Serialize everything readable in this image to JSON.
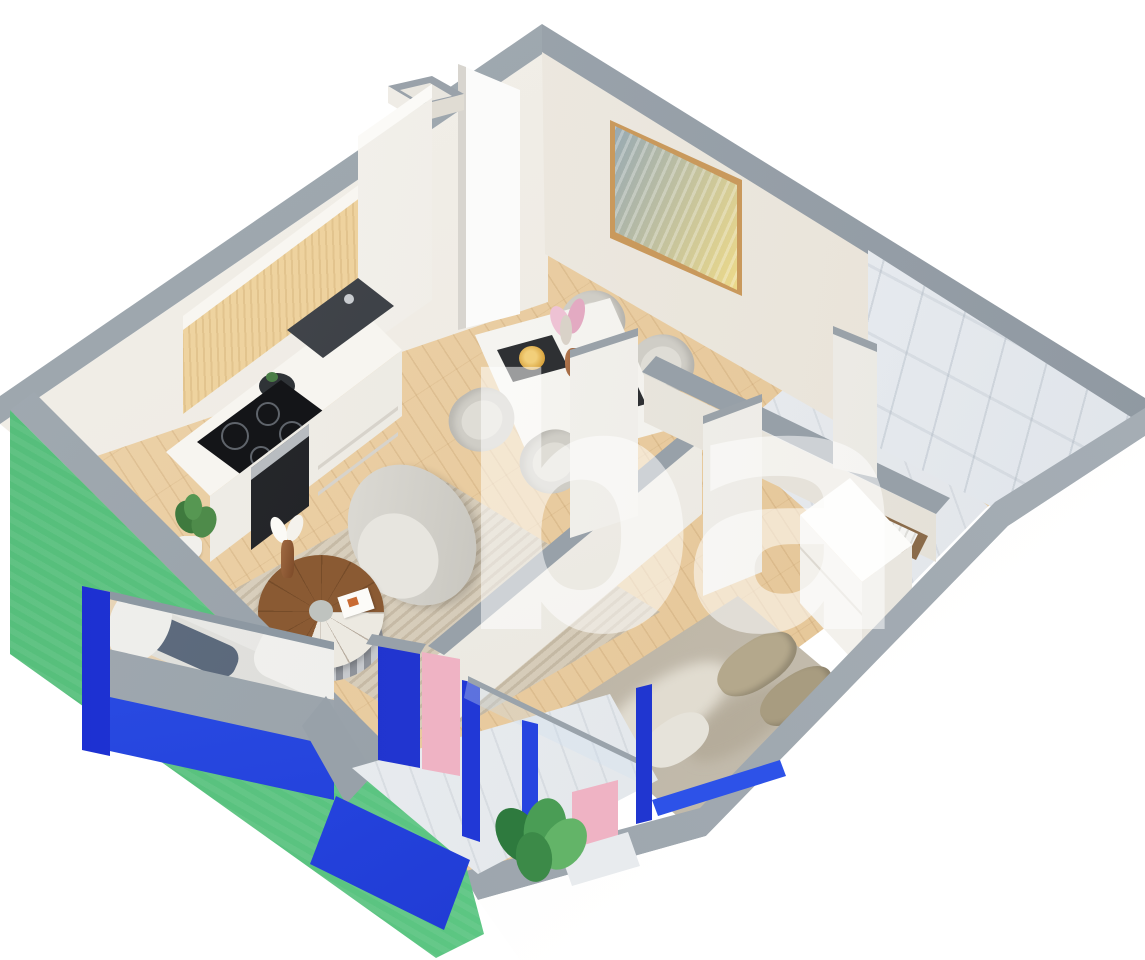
{
  "title": "Isometric 3D apartment floor plan render",
  "canvas": {
    "width": 1145,
    "height": 960
  },
  "watermark": {
    "text": "ba",
    "color": "#ffffff",
    "opacity": 0.52
  },
  "palette": {
    "background": "#ffffff",
    "wall_top_gray": "#98a1a9",
    "wall_interior_white": "#f1eee8",
    "wall_interior_warm": "#e9e4da",
    "exterior_green": "#5ac381",
    "frame_blue_bright": "#2d52e8",
    "frame_blue_dark": "#1b2ed0",
    "accent_pink": "#efb3c4",
    "floor_wood": "#e8cba1",
    "cabinet_wood": "#eed29e",
    "marble_white": "#eef1f4",
    "cooktop_black": "#141518",
    "sofa_navy": "#27384f",
    "coffee_table_wood": "#8a5a33",
    "bedding_beige": "#c7c0b2",
    "art_frame_tan": "#c9995c"
  },
  "rooms": [
    {
      "name": "kitchen",
      "items": [
        "upper-cabinets",
        "tall-cabinet",
        "countertop",
        "sink",
        "cooktop",
        "oven",
        "potted-plant"
      ]
    },
    {
      "name": "dining-area",
      "items": [
        "dining-table",
        "four-chairs",
        "placemats",
        "flower-vase"
      ]
    },
    {
      "name": "living-room",
      "items": [
        "sofa",
        "armchair",
        "round-coffee-table",
        "striped-rug",
        "candle"
      ]
    },
    {
      "name": "bedroom",
      "items": [
        "double-bed",
        "pillows",
        "wardrobe"
      ]
    },
    {
      "name": "bathroom",
      "items": [
        "marble-wall",
        "marble-floor",
        "towel-shelf",
        "service-duct"
      ]
    },
    {
      "name": "balcony",
      "items": [
        "glass-railing",
        "pink-panels",
        "blue-frames",
        "plant",
        "marble-floor"
      ]
    },
    {
      "name": "entry",
      "items": [
        "open-door",
        "abstract-wall-art",
        "ventilation-shaft"
      ]
    }
  ]
}
